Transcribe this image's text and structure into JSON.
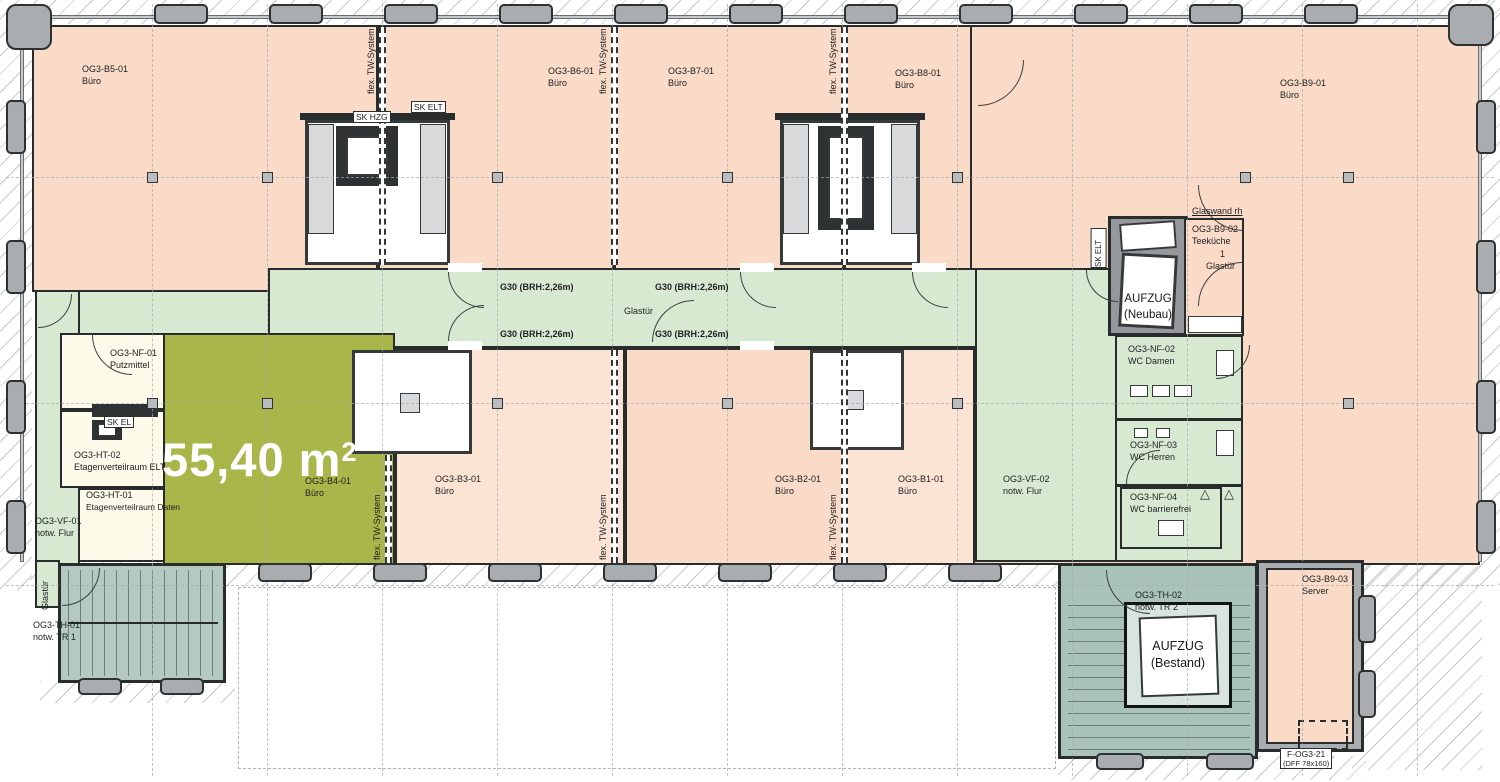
{
  "plan": {
    "highlight_area": "55,40 m",
    "highlight_sup": "2"
  },
  "rooms": {
    "b5": {
      "id": "OG3-B5-01",
      "type": "Büro"
    },
    "b6": {
      "id": "OG3-B6-01",
      "type": "Büro"
    },
    "b7": {
      "id": "OG3-B7-01",
      "type": "Büro"
    },
    "b8": {
      "id": "OG3-B8-01",
      "type": "Büro"
    },
    "b9": {
      "id": "OG3-B9-01",
      "type": "Büro"
    },
    "b4": {
      "id": "OG3-B4-01",
      "type": "Büro"
    },
    "b3": {
      "id": "OG3-B3-01",
      "type": "Büro"
    },
    "b2": {
      "id": "OG3-B2-01",
      "type": "Büro"
    },
    "b1": {
      "id": "OG3-B1-01",
      "type": "Büro"
    },
    "b9_02": {
      "id": "OG3-B9-02",
      "type": "Teeküche"
    },
    "b9_03": {
      "id": "OG3-B9-03",
      "type": "Server"
    },
    "nf01": {
      "id": "OG3-NF-01",
      "type": "Putzmittel"
    },
    "nf02": {
      "id": "OG3-NF-02",
      "type": "WC Damen"
    },
    "nf03": {
      "id": "OG3-NF-03",
      "type": "WC Herren"
    },
    "nf04": {
      "id": "OG3-NF-04",
      "type": "WC barrierefrei"
    },
    "ht01": {
      "id": "OG3-HT-01",
      "type": "Etagenverteilraum Daten"
    },
    "ht02": {
      "id": "OG3-HT-02",
      "type": "Etagenverteilraum ELT"
    },
    "vf01": {
      "id": "OG3-VF-01",
      "type": "notw. Flur"
    },
    "vf02": {
      "id": "OG3-VF-02",
      "type": "notw. Flur"
    },
    "th01": {
      "id": "OG3-TH-01",
      "type": "notw. TR 1"
    },
    "th02": {
      "id": "OG3-TH-02",
      "type": "notw. TR 2"
    }
  },
  "annotations": {
    "sk_hzg": "SK HZG",
    "sk_elt": "SK ELT",
    "sk_el": "SK EL",
    "flex_tw": "flex. TW-System",
    "g30": "G30 (BRH:2,26m)",
    "glastuer": "Glastür",
    "glaswand": "Glaswand rh",
    "count_one": "1"
  },
  "elevators": {
    "neubau_line1": "AUFZUG",
    "neubau_line2": "(Neubau)",
    "bestand_line1": "AUFZUG",
    "bestand_line2": "(Bestand)"
  },
  "window_tag": {
    "id": "F-OG3-21",
    "size": "(DFF 78x160)"
  },
  "colors": {
    "salmon": "#fadbc8",
    "salmon_light": "#fce4d4",
    "green": "#d8e9d2",
    "olive": "#a9b64a",
    "cream": "#fdfae9",
    "teal": "#b3c9c2",
    "teal2": "#a9c2ba",
    "facade": "#a9adb0",
    "shaft": "#95999c",
    "wall": "#292c2d"
  }
}
